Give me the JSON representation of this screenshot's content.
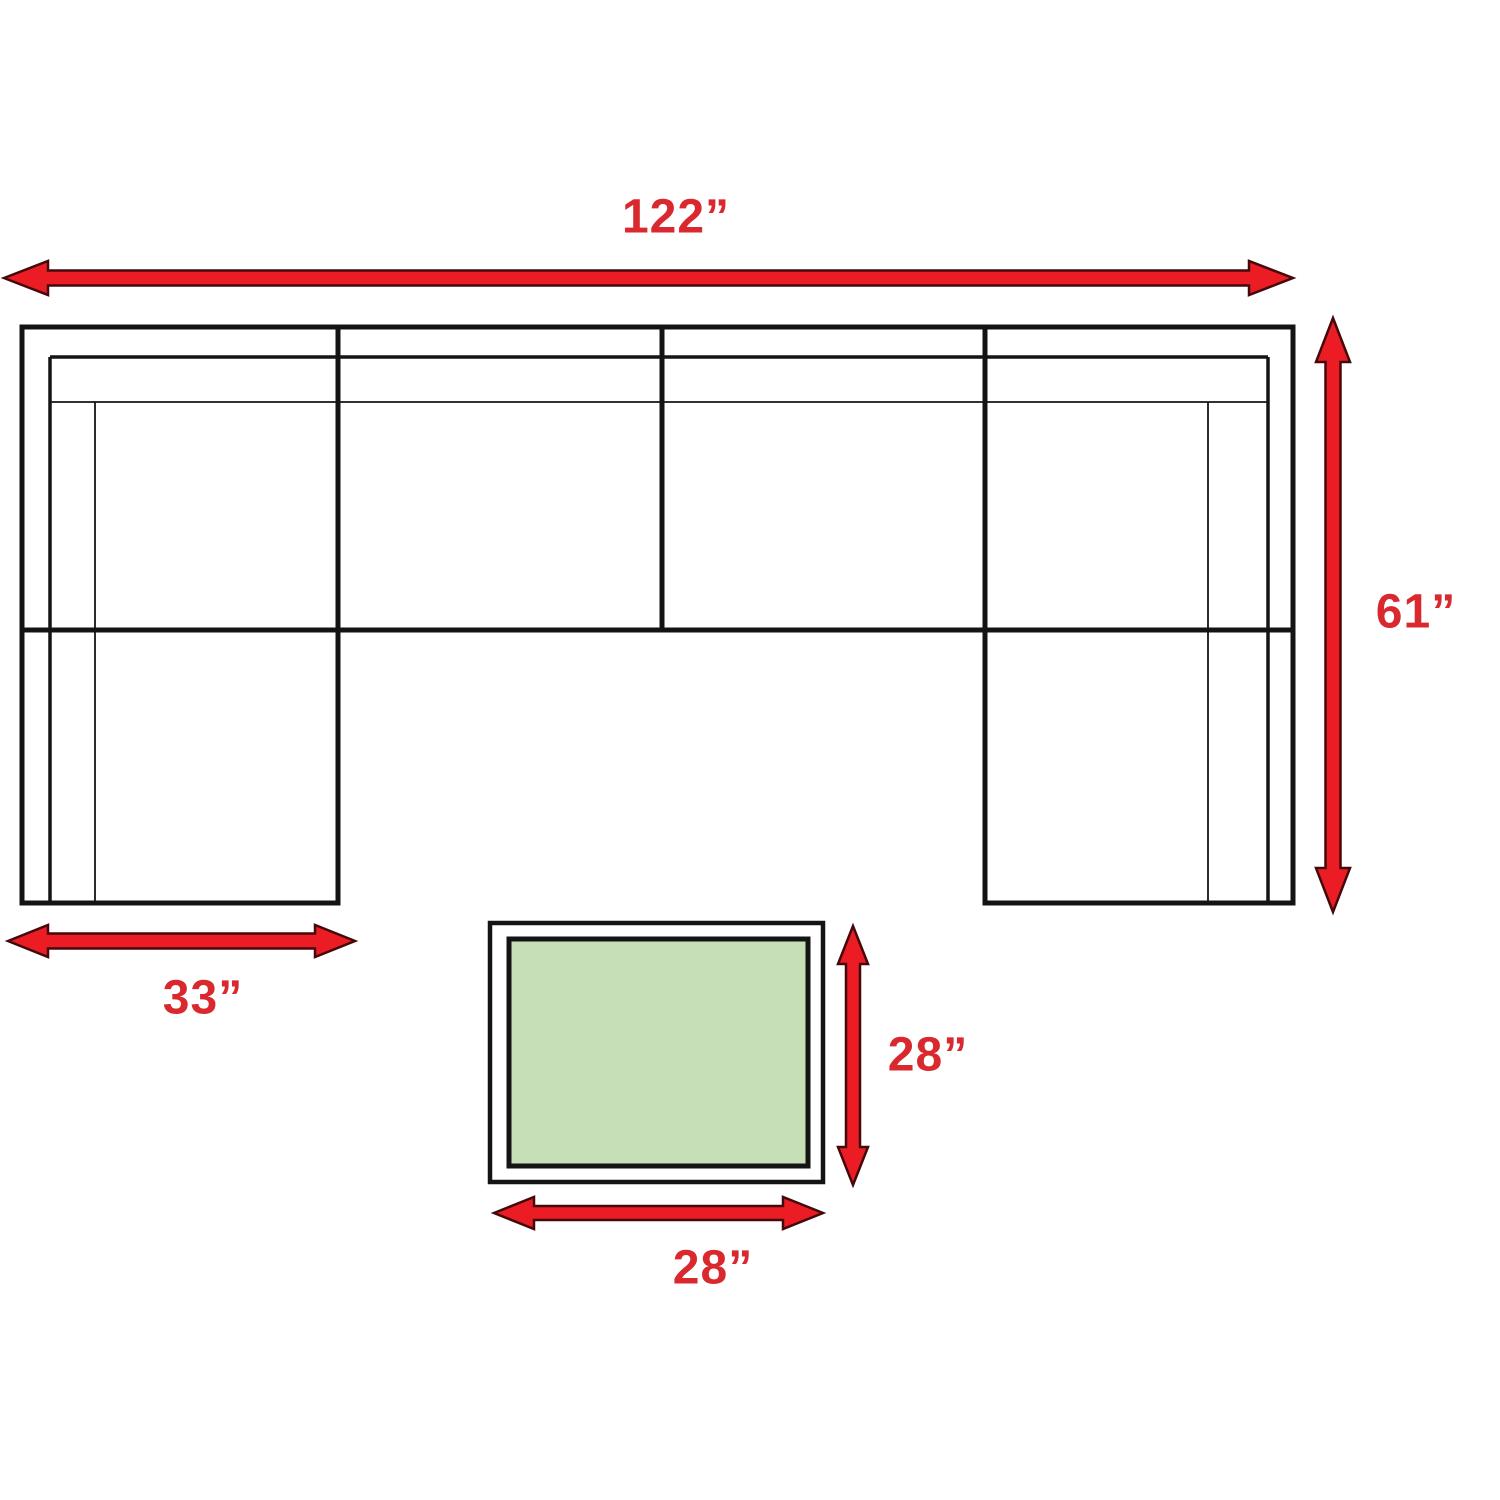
{
  "diagram": {
    "title": "sectional-sofa-and-coffee-table-dimension-diagram",
    "colors": {
      "background": "#ffffff",
      "line-color": "#141414",
      "arrow-fill": "#ec1c24",
      "arrow-outline": "#45090b",
      "label-color": "#d9292f",
      "table-fill": "#c6dfb6"
    },
    "dimensions": {
      "sofa_width": "122”",
      "sofa_depth": "61”",
      "chaise_width": "33”",
      "table_depth": "28”",
      "table_width": "28”"
    }
  }
}
